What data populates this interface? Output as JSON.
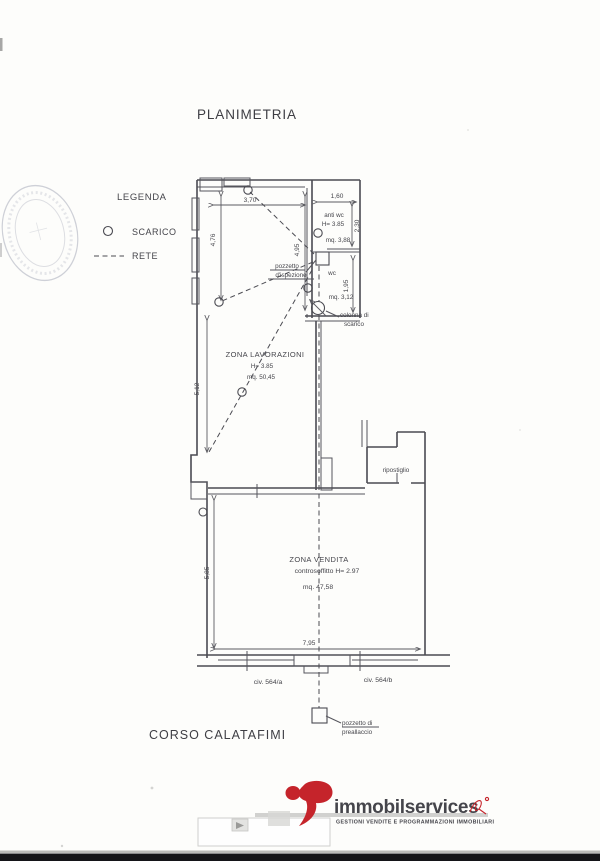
{
  "doc": {
    "title": "PLANIMETRIA",
    "street": "CORSO CALATAFIMI"
  },
  "legend": {
    "title": "LEGENDA",
    "scarico": "SCARICO",
    "rete": "RETE"
  },
  "rooms": {
    "lavorazioni": {
      "name": "ZONA LAVORAZIONI",
      "height": "H= 3.85",
      "area": "mq. 50,45"
    },
    "anti_wc": {
      "name": "anti wc",
      "height": "H= 3.85",
      "area": "mq. 3,88"
    },
    "wc": {
      "name": "wc",
      "area": "mq. 3,12"
    },
    "ripostiglio": {
      "name": "ripostiglio"
    },
    "vendita": {
      "name": "ZONA VENDITA",
      "ceiling": "controsoffitto  H= 2.97",
      "area": "mq. 47,58"
    }
  },
  "dims": {
    "top_width": "3,70",
    "antiwc_width": "1,60",
    "antiwc_depth": "2,30",
    "entry_left": "4,76",
    "entry_right": "4,95",
    "wc_depth": "1,95",
    "lavorazioni_left": "5,12",
    "vendita_left": "5,85",
    "vendita_width": "7,95"
  },
  "annotations": {
    "pozzetto_line1": "pozzetto",
    "pozzetto_line2": "d'ispezione",
    "colonna_line1": "colonna di",
    "colonna_line2": "scarico",
    "preallaccio_line1": "pozzetto di",
    "preallaccio_line2": "preallaccio",
    "civ_a": "civ. 564/a",
    "civ_b": "civ. 564/b"
  },
  "footer": {
    "brand": "immobilservices",
    "tagline": "GESTIONI VENDITE E PROGRAMMAZIONI IMMOBILIARI",
    "brand_color": "#a91e23",
    "accent_color": "#c5242b",
    "tagline_color": "#c03a30"
  }
}
